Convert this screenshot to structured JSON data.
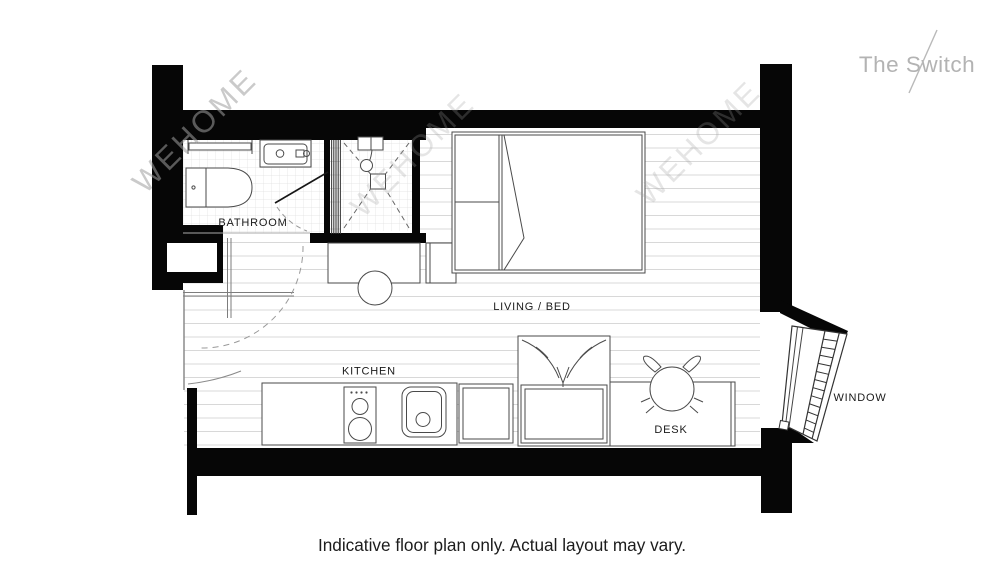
{
  "brand": {
    "logo_text": "The Switch"
  },
  "watermark": {
    "text": "WEHOME"
  },
  "plan": {
    "labels": {
      "bathroom": "BATHROOM",
      "living_bed": "LIVING / BED",
      "kitchen": "KITCHEN",
      "desk": "DESK",
      "window": "WINDOW"
    }
  },
  "caption": "Indicative floor plan only. Actual layout may vary.",
  "colors": {
    "background": "#ffffff",
    "wall": "#060606",
    "fixture_line": "#4a4a4a",
    "floor_line": "#d8d8d8",
    "tile_line": "#e0e0e0",
    "label_text": "#1a1a1a",
    "caption_text": "#1c1c1c",
    "logo_text": "#b3b3b3",
    "watermark_text": "#9f9f9f"
  }
}
